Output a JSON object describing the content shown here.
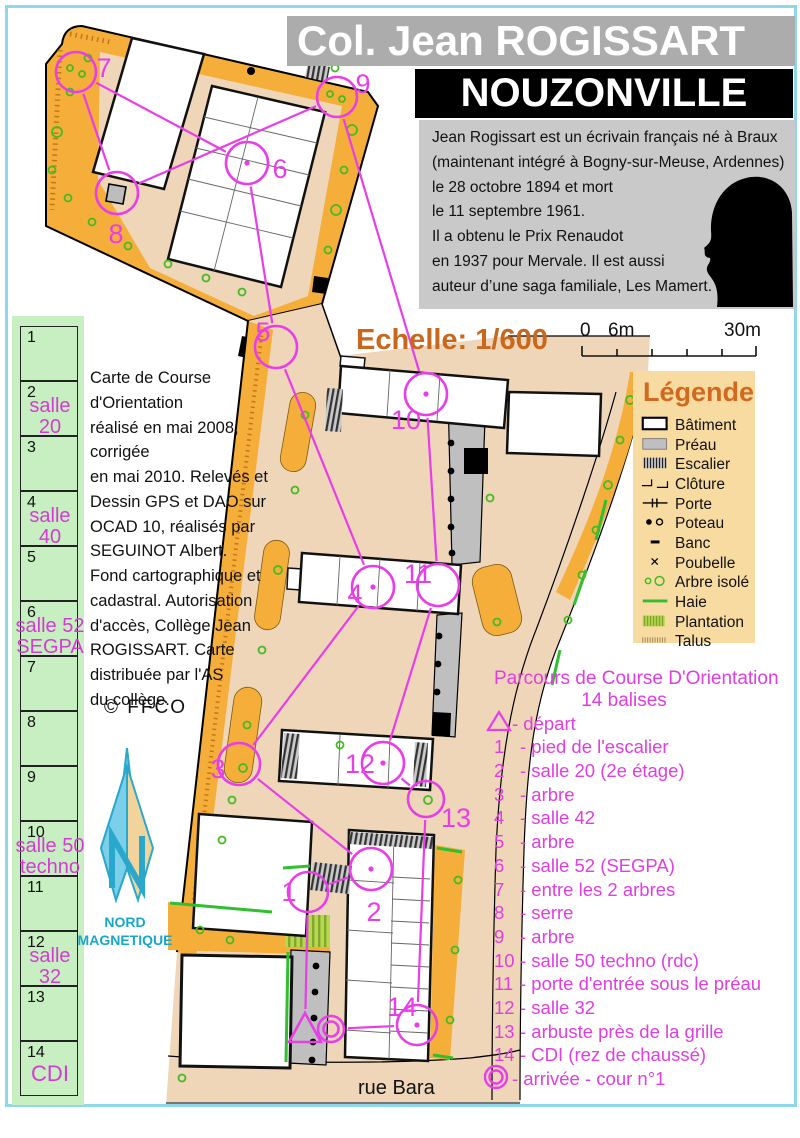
{
  "header": {
    "school": "Col. Jean ROGISSART",
    "city": "NOUZONVILLE"
  },
  "bio": {
    "text": "Jean Rogissart est un écrivain français né à Braux\n(maintenant intégré à Bogny-sur-Meuse, Ardennes)\nle 28 octobre 1894 et mort\nle 11 septembre 1961.\nIl a obtenu le Prix Renaudot\nen 1937 pour Mervale. Il est aussi\nauteur d’une saga familiale, Les Mamert."
  },
  "scale": {
    "label": "Echelle: 1/600",
    "bar_labels": [
      "0",
      "6m",
      "30m"
    ]
  },
  "legend": {
    "title": "Légende",
    "items": [
      {
        "icon": "batiment-icon",
        "label": "Bâtiment"
      },
      {
        "icon": "preau-icon",
        "label": "Préau"
      },
      {
        "icon": "escalier-icon",
        "label": "Escalier"
      },
      {
        "icon": "cloture-icon",
        "label": "Clôture"
      },
      {
        "icon": "porte-icon",
        "label": "Porte"
      },
      {
        "icon": "poteau-icon",
        "label": "Poteau"
      },
      {
        "icon": "banc-icon",
        "label": "Banc"
      },
      {
        "icon": "poubelle-icon",
        "label": "Poubelle"
      },
      {
        "icon": "arbre-icon",
        "label": "Arbre isolé"
      },
      {
        "icon": "haie-icon",
        "label": "Haie"
      },
      {
        "icon": "plantation-icon",
        "label": "Plantation"
      },
      {
        "icon": "talus-icon",
        "label": "Talus"
      }
    ]
  },
  "credits": {
    "text": "Carte de Course d'Orientation\nréalisé en mai 2008, corrigée\nen mai 2010. Relevés et\nDessin GPS et DAO sur\nOCAD 10, réalisés par\nSEGUINOT Albert.\nFond cartographique et\ncadastral. Autorisation\nd'accès, Collège Jean\nROGISSART. Carte\ndistribuée par l'AS\ndu collège.",
    "copyright": "© FFCO"
  },
  "compass": {
    "label": "NORD\nMAGNETIQUE"
  },
  "sidebar": {
    "cells": [
      {
        "num": "1",
        "label": ""
      },
      {
        "num": "2",
        "label": "salle\n20"
      },
      {
        "num": "3",
        "label": ""
      },
      {
        "num": "4",
        "label": "salle\n40"
      },
      {
        "num": "5",
        "label": ""
      },
      {
        "num": "6",
        "label": "salle 52\nSEGPA"
      },
      {
        "num": "7",
        "label": ""
      },
      {
        "num": "8",
        "label": ""
      },
      {
        "num": "9",
        "label": ""
      },
      {
        "num": "10",
        "label": "salle 50\ntechno"
      },
      {
        "num": "11",
        "label": ""
      },
      {
        "num": "12",
        "label": "salle\n32"
      },
      {
        "num": "13",
        "label": ""
      },
      {
        "num": "14",
        "label": "CDI"
      }
    ]
  },
  "course": {
    "title": "Parcours de Course D'Orientation",
    "subtitle": "14 balises",
    "items": [
      {
        "marker": "triangle",
        "text": "-  départ"
      },
      {
        "marker": "1",
        "text": "- pied de l'escalier"
      },
      {
        "marker": "2",
        "text": "- salle 20 (2e étage)"
      },
      {
        "marker": "3",
        "text": "- arbre"
      },
      {
        "marker": "4",
        "text": "- salle 42"
      },
      {
        "marker": "5",
        "text": "- arbre"
      },
      {
        "marker": "6",
        "text": "- salle 52 (SEGPA)"
      },
      {
        "marker": "7",
        "text": "- entre les 2 arbres"
      },
      {
        "marker": "8",
        "text": "- serre"
      },
      {
        "marker": "9",
        "text": "- arbre"
      },
      {
        "marker": "10",
        "text": "- salle 50 techno (rdc)"
      },
      {
        "marker": "11",
        "text": "- porte d'entrée sous le préau"
      },
      {
        "marker": "12",
        "text": "- salle 32"
      },
      {
        "marker": "13",
        "text": "- arbuste près de la grille"
      },
      {
        "marker": "14",
        "text": "- CDI (rez de chaussé)"
      },
      {
        "marker": "finish",
        "text": "-  arrivée - cour n°1"
      }
    ]
  },
  "map": {
    "street": "rue Bara",
    "magenta": "#E83EE8",
    "controls": [
      {
        "id": "1",
        "x": 308,
        "y": 892,
        "r": 20,
        "lx": 281,
        "ly": 880,
        "dot": false
      },
      {
        "id": "2",
        "x": 371,
        "y": 869,
        "r": 21,
        "lx": 366,
        "ly": 900,
        "dot": true
      },
      {
        "id": "3",
        "x": 239,
        "y": 764,
        "r": 21,
        "lx": 210,
        "ly": 757,
        "dot": false
      },
      {
        "id": "4",
        "x": 373,
        "y": 587,
        "r": 21,
        "lx": 347,
        "ly": 582,
        "dot": true
      },
      {
        "id": "5",
        "x": 276,
        "y": 347,
        "r": 21,
        "lx": 255,
        "ly": 320,
        "dot": false
      },
      {
        "id": "6",
        "x": 247,
        "y": 163,
        "r": 21,
        "lx": 272,
        "ly": 157,
        "dot": true
      },
      {
        "id": "7",
        "x": 76,
        "y": 72,
        "r": 20,
        "lx": 96,
        "ly": 56,
        "dot": false
      },
      {
        "id": "8",
        "x": 117,
        "y": 193,
        "r": 21,
        "lx": 108,
        "ly": 222,
        "dot": false
      },
      {
        "id": "9",
        "x": 337,
        "y": 97,
        "r": 20,
        "lx": 355,
        "ly": 72,
        "dot": false
      },
      {
        "id": "10",
        "x": 426,
        "y": 394,
        "r": 21,
        "lx": 398,
        "ly": 408,
        "dot": true
      },
      {
        "id": "11",
        "x": 438,
        "y": 585,
        "r": 21,
        "lx": 410,
        "ly": 562,
        "dot": false
      },
      {
        "id": "12",
        "x": 383,
        "y": 763,
        "r": 21,
        "lx": 352,
        "ly": 752,
        "dot": true
      },
      {
        "id": "13",
        "x": 426,
        "y": 799,
        "r": 18,
        "lx": 448,
        "ly": 806,
        "dot": false
      },
      {
        "id": "14",
        "x": 417,
        "y": 1025,
        "r": 20,
        "lx": 394,
        "ly": 995,
        "dot": true
      }
    ],
    "start": {
      "x": 305,
      "y": 1030,
      "r": 18
    },
    "finish": {
      "x": 331,
      "y": 1029,
      "r": 14
    },
    "route": [
      "start",
      "1",
      "2",
      "3",
      "4",
      "5",
      "6",
      "7",
      "8",
      "9",
      "10",
      "11",
      "12",
      "13",
      "14",
      "finish"
    ]
  }
}
